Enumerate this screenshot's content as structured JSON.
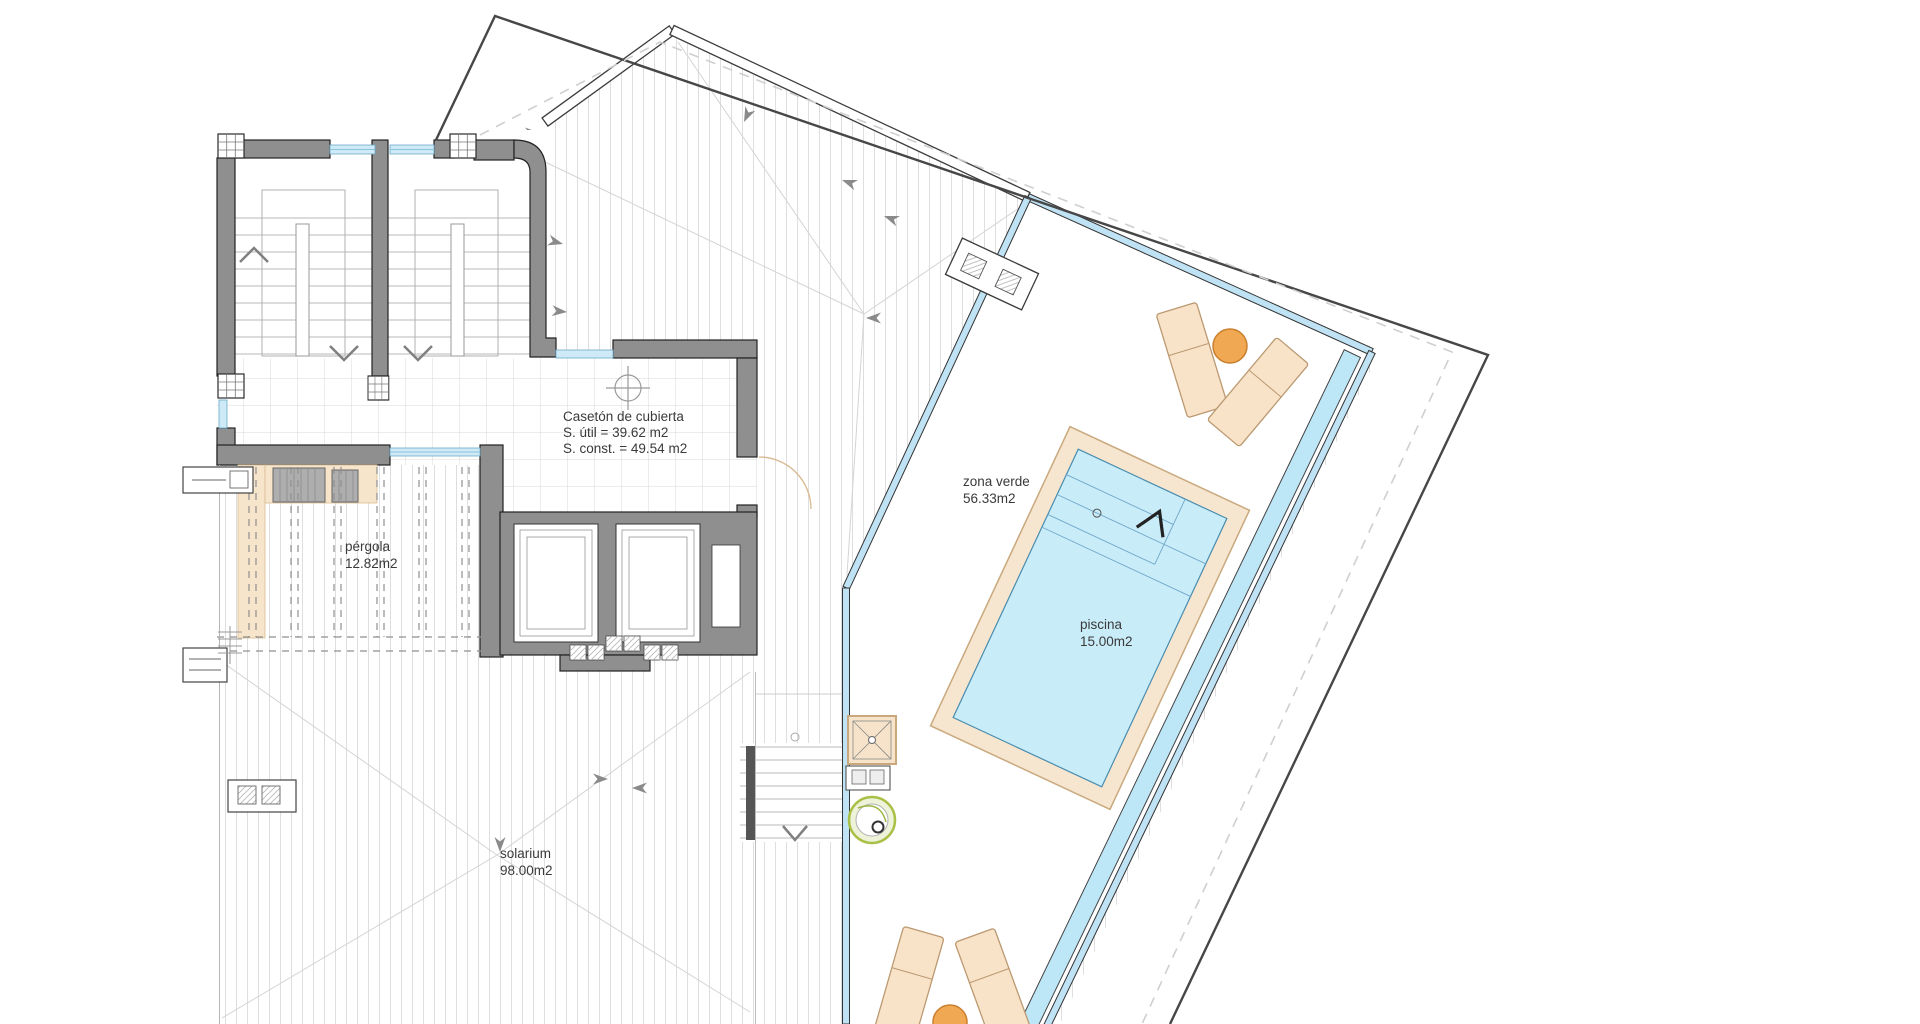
{
  "plan": {
    "type": "architectural roof plan",
    "labels": {
      "caseton": {
        "title": "Casetón de cubierta",
        "util": "S. útil = 39.62 m2",
        "const": "S. const. = 49.54 m2"
      },
      "zona_verde": {
        "name": "zona verde",
        "area": "56.33m2"
      },
      "piscina": {
        "name": "piscina",
        "area": "15.00m2"
      },
      "pergola": {
        "name": "pérgola",
        "area": "12.82m2"
      },
      "solarium": {
        "name": "solarium",
        "area": "98.00m2"
      }
    },
    "colors": {
      "wall_gray": "#8f8f8f",
      "pool_water": "#c9ecf9",
      "pool_coping": "#f7e6cf",
      "glass_balustrade": "#bfe3f5",
      "overflow_channel": "#bde6f6",
      "furniture_beige": "#f8e3c9",
      "table_orange": "#f0a852",
      "planter_green": "#a9c047",
      "boundary_dark": "#474747"
    }
  }
}
